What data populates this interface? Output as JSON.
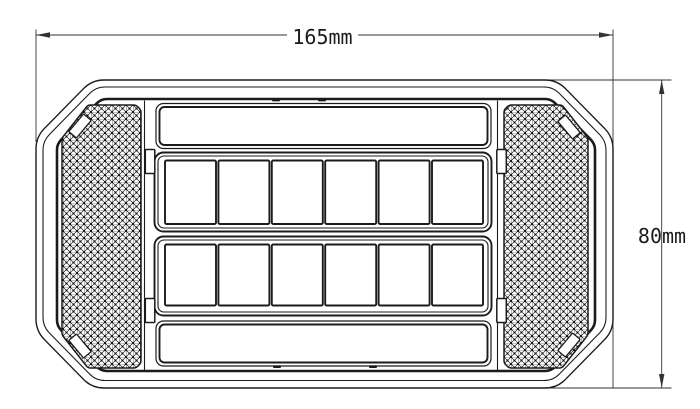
{
  "colors": {
    "line": "#1b1b1b",
    "background": "#ffffff"
  },
  "dimensions": {
    "width_label": "165mm",
    "height_label": "80mm"
  },
  "lamp": {
    "led_grid": {
      "rows": 2,
      "columns": 6
    },
    "reflectors": {
      "sides": [
        "left",
        "right"
      ],
      "tabs_per_reflector": 2
    },
    "lens_bars": [
      "top",
      "bottom"
    ],
    "mounting_clips": 4
  }
}
